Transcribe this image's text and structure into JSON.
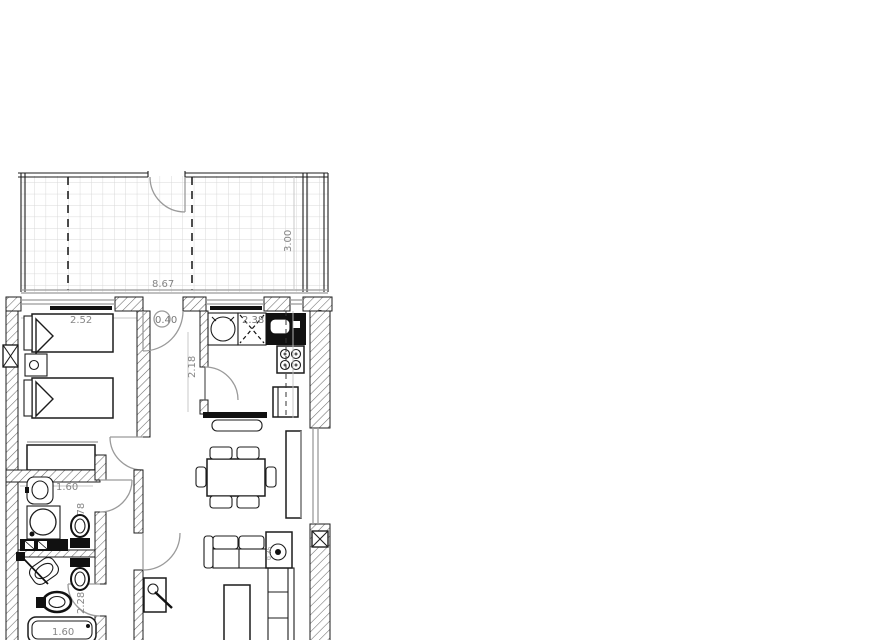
{
  "page": {
    "type": "architectural-floor-plan",
    "background": "#ffffff"
  },
  "colors": {
    "wall_line": "#1c1c1c",
    "hatch_line": "#666666",
    "door_arc": "#9a9a9a",
    "grid_line": "#d9d9d9",
    "dimension_text": "#858585",
    "fixture_fill": "#111111"
  },
  "labels": {
    "terrace_width": "8.67",
    "terrace_depth": "3.00",
    "bedroom_width": "2.52",
    "hall_door_width": "0.40",
    "hall_depth": "2.18",
    "kitchen_width": "2.38",
    "bathroom1_width": "1.60",
    "bathroom1_depth": "1.78",
    "bathroom2_depth": "2.28",
    "bathtub_length": "1.60",
    "side_table_size": "0.35"
  }
}
